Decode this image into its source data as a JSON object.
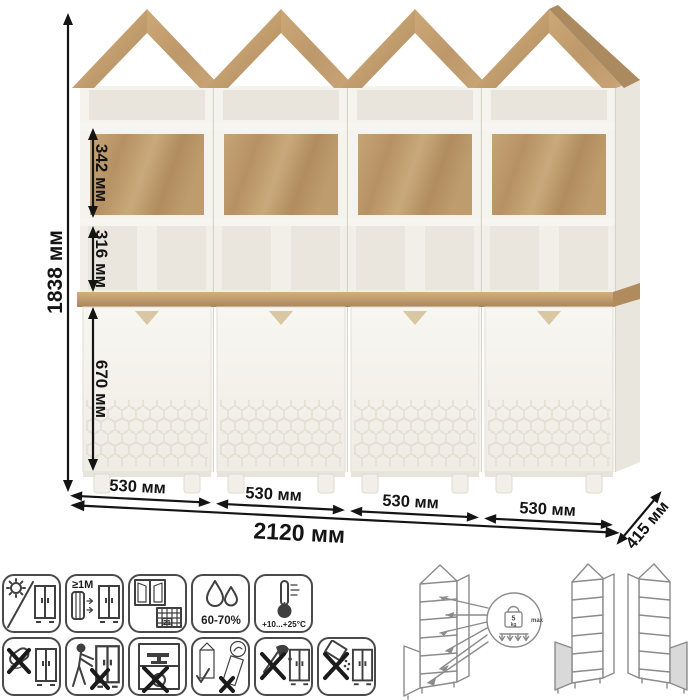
{
  "dimensions": {
    "height": "1838 мм",
    "section_top": "342 мм",
    "section_middle": "316 мм",
    "section_doors": "670 мм",
    "unit_width": "530 мм",
    "total_width": "2120 мм",
    "depth": "415 мм"
  },
  "care_icons": {
    "row1": [
      {
        "name": "avoid-direct-sunlight"
      },
      {
        "name": "keep-1m-from-heat-sources",
        "label": "≥1М"
      },
      {
        "name": "ventilate-room-acclimatize",
        "calendar_day": "21"
      },
      {
        "name": "relative-humidity",
        "label": "60-70%"
      },
      {
        "name": "temperature-range",
        "label": "+10...+25°C"
      }
    ],
    "row2": [
      {
        "name": "no-wet-cleaning"
      },
      {
        "name": "do-not-drag"
      },
      {
        "name": "do-not-overload"
      },
      {
        "name": "transport-upright-only"
      },
      {
        "name": "no-sharp-tools"
      },
      {
        "name": "no-abrasive-cleaners"
      }
    ]
  },
  "load_diagram": {
    "weight": "5",
    "weight_unit": "kg",
    "max_label": "max"
  },
  "colors": {
    "wood": "#bb9569",
    "wood_light": "#cfad80",
    "wood_dark": "#a8875c",
    "cabinet_white": "#f5f3ed",
    "dimension_ink": "#141414",
    "icon_stroke": "#3f3f3f"
  }
}
